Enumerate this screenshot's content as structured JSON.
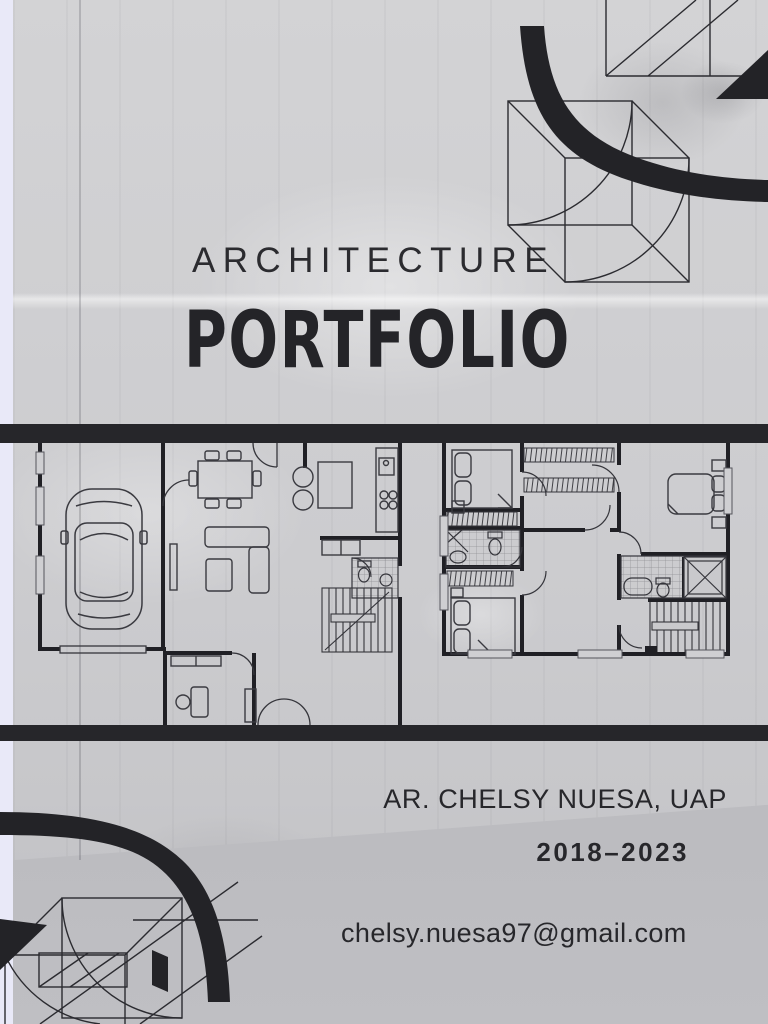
{
  "page": {
    "eyebrow": "ARCHITECTURE",
    "title": "PORTFOLIO",
    "author": "AR. CHELSY NUESA, UAP",
    "years": "2018–2023",
    "email": "chelsy.nuesa97@gmail.com"
  },
  "colors": {
    "ink": "#27272b",
    "bar": "#26262a",
    "concrete_light": "#d3d3d5",
    "concrete_mid": "#c7c7ca",
    "floor": "#b2b2b6",
    "gutter": "#e9e9f8"
  },
  "graphics": {
    "floor_plan": "two-unit residential floor plan between two black bars (garage with car, dining, sofa, kitchen, stairs, bedrooms, closets, bathrooms)",
    "decoration_top_right": "wireframe cube with quarter-circle arcs, black swoosh and black triangle",
    "decoration_bottom_left": "mirrored wireframe cube with quarter-circle arcs, black swoosh and black triangle"
  }
}
